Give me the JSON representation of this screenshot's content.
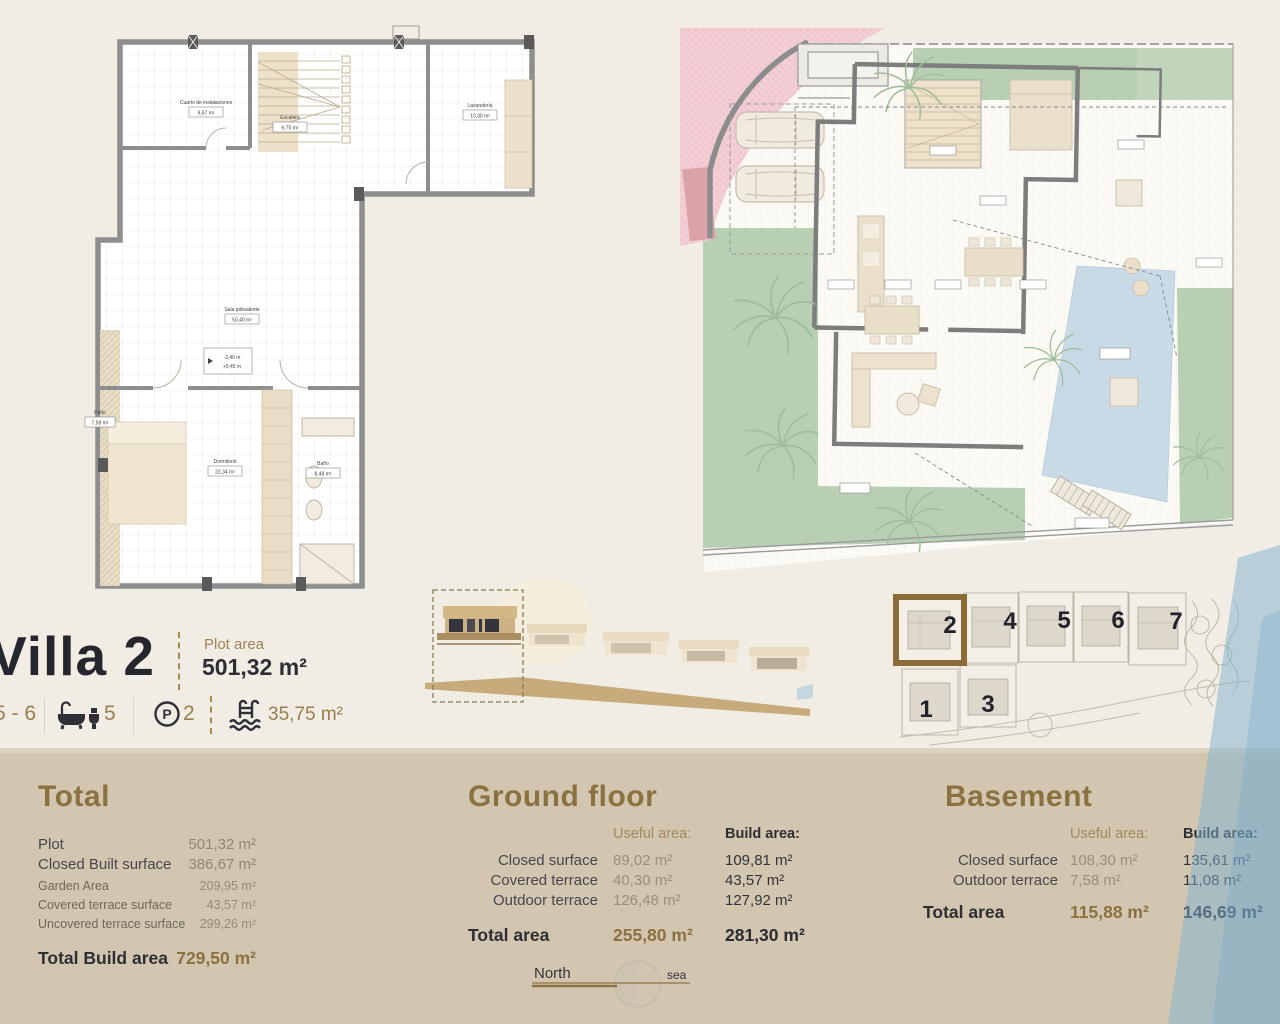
{
  "header": {
    "title": "Villa 2",
    "plot_area_label": "Plot area",
    "plot_area_value": "501,32 m²",
    "features": {
      "bedrooms": "5 - 6",
      "bathrooms": "5",
      "parking_symbol": "P",
      "parking_count": "2",
      "pool_area": "35,75 m²"
    }
  },
  "basement_plan": {
    "rooms": [
      {
        "name": "Cuarto de instalaciones",
        "area": "9,67 m²"
      },
      {
        "name": "Escalera",
        "area": "6,70 m²"
      },
      {
        "name": "Lavandería",
        "area": "10,30 m²"
      },
      {
        "name": "Sala polivalente",
        "area": "50,40 m²"
      },
      {
        "name": "Patio",
        "area": "7,58 m²"
      },
      {
        "name": "Dormitorio",
        "area": "22,34 m²"
      },
      {
        "name": "Baño",
        "area": "8,48 m²"
      }
    ],
    "level_marker": {
      "line1": "-3,40 m",
      "line2": "+0,45 m"
    }
  },
  "site_plan": {
    "highlighted_villa": "2",
    "villa_numbers": [
      "2",
      "4",
      "5",
      "6",
      "7",
      "1",
      "3"
    ]
  },
  "compass": {
    "north_label": "North",
    "sea_label": "sea"
  },
  "tables": {
    "total": {
      "heading": "Total",
      "rows": [
        {
          "label": "Plot",
          "value": "501,32 m²"
        },
        {
          "label": "Closed Built surface",
          "value": "386,67 m²"
        },
        {
          "label": "Garden Area",
          "value": "209,95 m²"
        },
        {
          "label": "Covered terrace surface",
          "value": "43,57 m²"
        },
        {
          "label": "Uncovered terrace surface",
          "value": "299,26 m²"
        }
      ],
      "total_row": {
        "label": "Total Build area",
        "value": "729,50 m²"
      }
    },
    "ground_floor": {
      "heading": "Ground floor",
      "col_useful": "Useful  area:",
      "col_build": "Build area:",
      "rows": [
        {
          "label": "Closed surface",
          "useful": "89,02 m²",
          "build": "109,81 m²"
        },
        {
          "label": "Covered terrace",
          "useful": "40,30 m²",
          "build": "43,57 m²"
        },
        {
          "label": "Outdoor terrace",
          "useful": "126,48 m²",
          "build": "127,92 m²"
        }
      ],
      "total_row": {
        "label": "Total area",
        "useful": "255,80 m²",
        "build": "281,30 m²"
      }
    },
    "basement": {
      "heading": "Basement",
      "col_useful": "Useful  area:",
      "col_build": "Build area:",
      "rows": [
        {
          "label": "Closed surface",
          "useful": "108,30 m²",
          "build": "135,61 m²"
        },
        {
          "label": "Outdoor terrace",
          "useful": "7,58 m²",
          "build": "11,08 m²"
        }
      ],
      "total_row": {
        "label": "Total area",
        "useful": "115,88 m²",
        "build": "146,69 m²"
      }
    }
  },
  "colors": {
    "accent_gold": "#997d4b",
    "dark_text": "#2b2b33",
    "footer_bg": "#d2c6b0",
    "page_bg": "#f1ede4",
    "garden_green": "#b8cfb4",
    "pool_blue": "#c9dae7",
    "road_pink": "#f2cdd4",
    "sea_wedge_blue": "#a9c3d4",
    "highlight_box": "#8a6c39"
  }
}
